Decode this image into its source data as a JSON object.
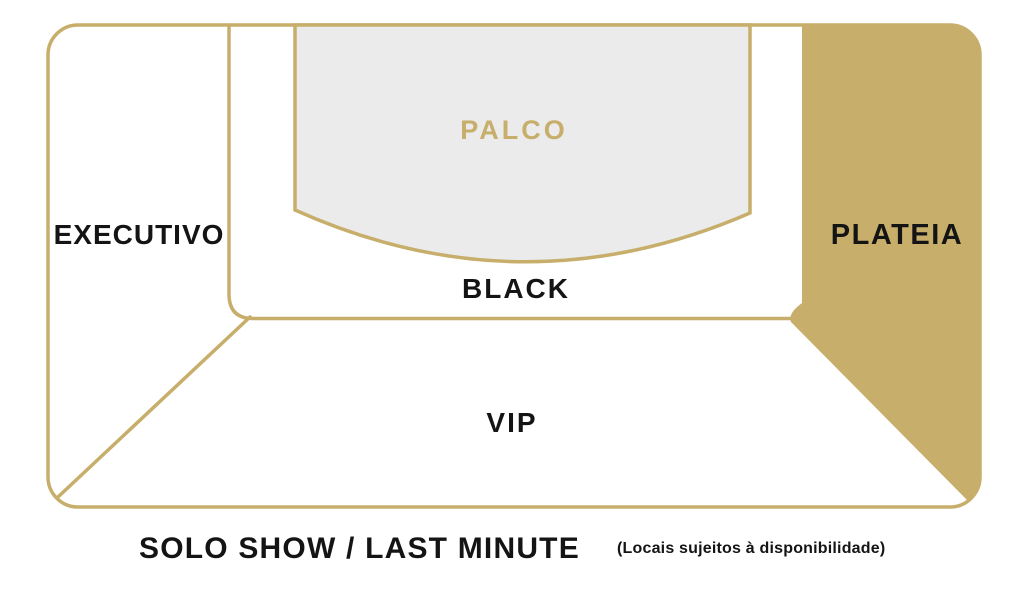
{
  "title": "SOLO SHOW / LAST MINUTE",
  "availability_note": "(Locais sujeitos à disponibilidade)",
  "sections": {
    "executivo": {
      "label": "EXECUTIVO"
    },
    "palco": {
      "label": "PALCO"
    },
    "black": {
      "label": "BLACK"
    },
    "plateia": {
      "label": "PLATEIA"
    },
    "vip": {
      "label": "VIP"
    }
  },
  "colors": {
    "gold": "#C7AE6B",
    "stage_fill": "#EBEBEC",
    "label_black": "#141414",
    "background": "#FFFFFF"
  }
}
